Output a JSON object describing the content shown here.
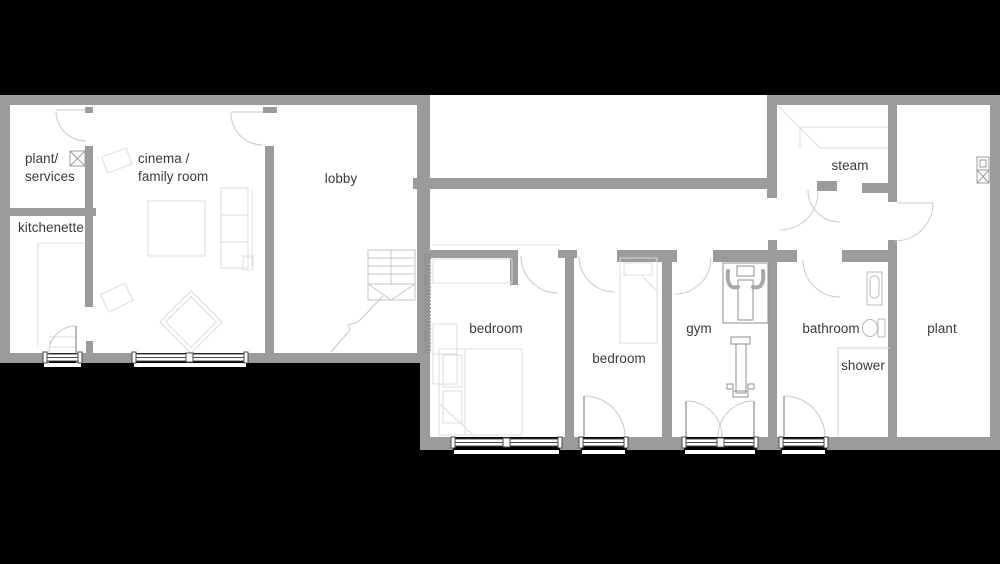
{
  "scene": {
    "background": "#000000",
    "floor_color": "#ffffff",
    "wall_color": "#9b9b9b",
    "text_color": "#3a3a3a"
  },
  "floor_plan": {
    "rooms": [
      {
        "id": "plant-services",
        "lines": [
          "plant/",
          "services"
        ],
        "x": 25,
        "y": 150,
        "align": "left"
      },
      {
        "id": "cinema-family-room",
        "lines": [
          "cinema /",
          "family room"
        ],
        "x": 138,
        "y": 150,
        "align": "left"
      },
      {
        "id": "kitchenette",
        "lines": [
          "kitchenette"
        ],
        "x": 18,
        "y": 219,
        "align": "left"
      },
      {
        "id": "lobby",
        "lines": [
          "lobby"
        ],
        "x": 341,
        "y": 170,
        "align": "center"
      },
      {
        "id": "bedroom-1",
        "lines": [
          "bedroom"
        ],
        "x": 496,
        "y": 320,
        "align": "center"
      },
      {
        "id": "bedroom-2",
        "lines": [
          "bedroom"
        ],
        "x": 619,
        "y": 350,
        "align": "center"
      },
      {
        "id": "gym",
        "lines": [
          "gym"
        ],
        "x": 699,
        "y": 320,
        "align": "center"
      },
      {
        "id": "bathroom",
        "lines": [
          "bathroom"
        ],
        "x": 831,
        "y": 320,
        "align": "center"
      },
      {
        "id": "shower",
        "lines": [
          "shower"
        ],
        "x": 863,
        "y": 357,
        "align": "center"
      },
      {
        "id": "plant",
        "lines": [
          "plant"
        ],
        "x": 942,
        "y": 320,
        "align": "center"
      },
      {
        "id": "steam",
        "lines": [
          "steam"
        ],
        "x": 850,
        "y": 157,
        "align": "center"
      }
    ]
  }
}
